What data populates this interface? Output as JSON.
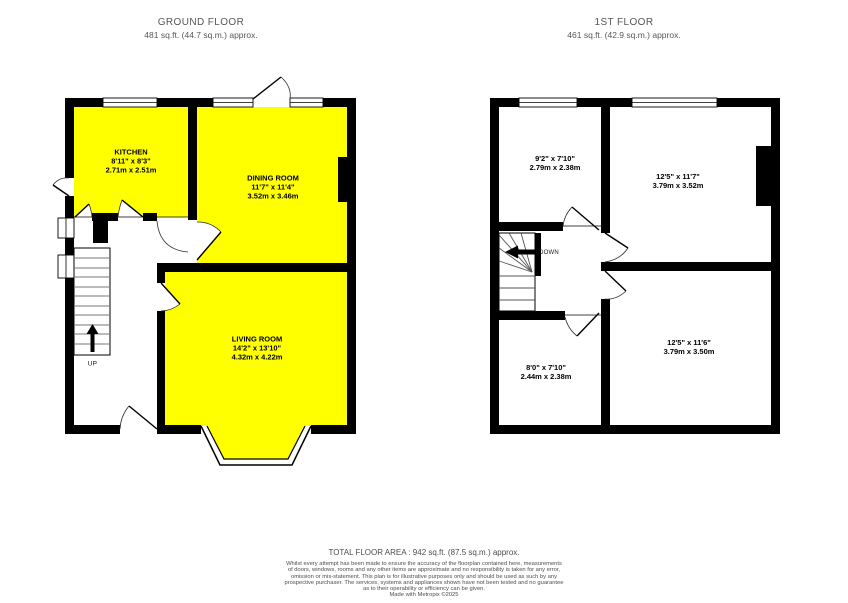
{
  "colors": {
    "room_fill": "#ffff00",
    "wall": "#000000",
    "muted_text": "#575757"
  },
  "ground_floor": {
    "title": "GROUND FLOOR",
    "area": "481 sq.ft. (44.7 sq.m.) approx.",
    "rooms": [
      {
        "name": "KITCHEN",
        "dims_ft": "8'11\" x 8'3\"",
        "dims_m": "2.71m x 2.51m"
      },
      {
        "name": "DINING ROOM",
        "dims_ft": "11'7\" x 11'4\"",
        "dims_m": "3.52m x 3.46m"
      },
      {
        "name": "LIVING ROOM",
        "dims_ft": "14'2\" x 13'10\"",
        "dims_m": "4.32m x 4.22m"
      }
    ],
    "stairs_label": "UP"
  },
  "first_floor": {
    "title": "1ST FLOOR",
    "area": "461 sq.ft. (42.9 sq.m.) approx.",
    "rooms": [
      {
        "dims_ft": "9'2\" x 7'10\"",
        "dims_m": "2.79m x 2.38m"
      },
      {
        "dims_ft": "12'5\" x 11'7\"",
        "dims_m": "3.79m x 3.52m"
      },
      {
        "dims_ft": "8'0\" x 7'10\"",
        "dims_m": "2.44m x 2.38m"
      },
      {
        "dims_ft": "12'5\" x 11'6\"",
        "dims_m": "3.79m x 3.50m"
      }
    ],
    "stairs_label": "DOWN"
  },
  "footer": {
    "total_area": "TOTAL FLOOR AREA : 942 sq.ft. (87.5 sq.m.) approx.",
    "disclaimer_lines": [
      "Whilst every attempt has been made to ensure the accuracy of the floorplan contained here, measurements",
      "of doors, windows, rooms and any other items are approximate and no responsibility is taken for any error,",
      "omission or mis-statement. This plan is for illustrative purposes only and should be used as such by any",
      "prospective purchaser. The services, systems and appliances shown have not been tested and no guarantee",
      "as to their operability or efficiency can be given."
    ],
    "credit": "Made with Metropix ©2025"
  }
}
